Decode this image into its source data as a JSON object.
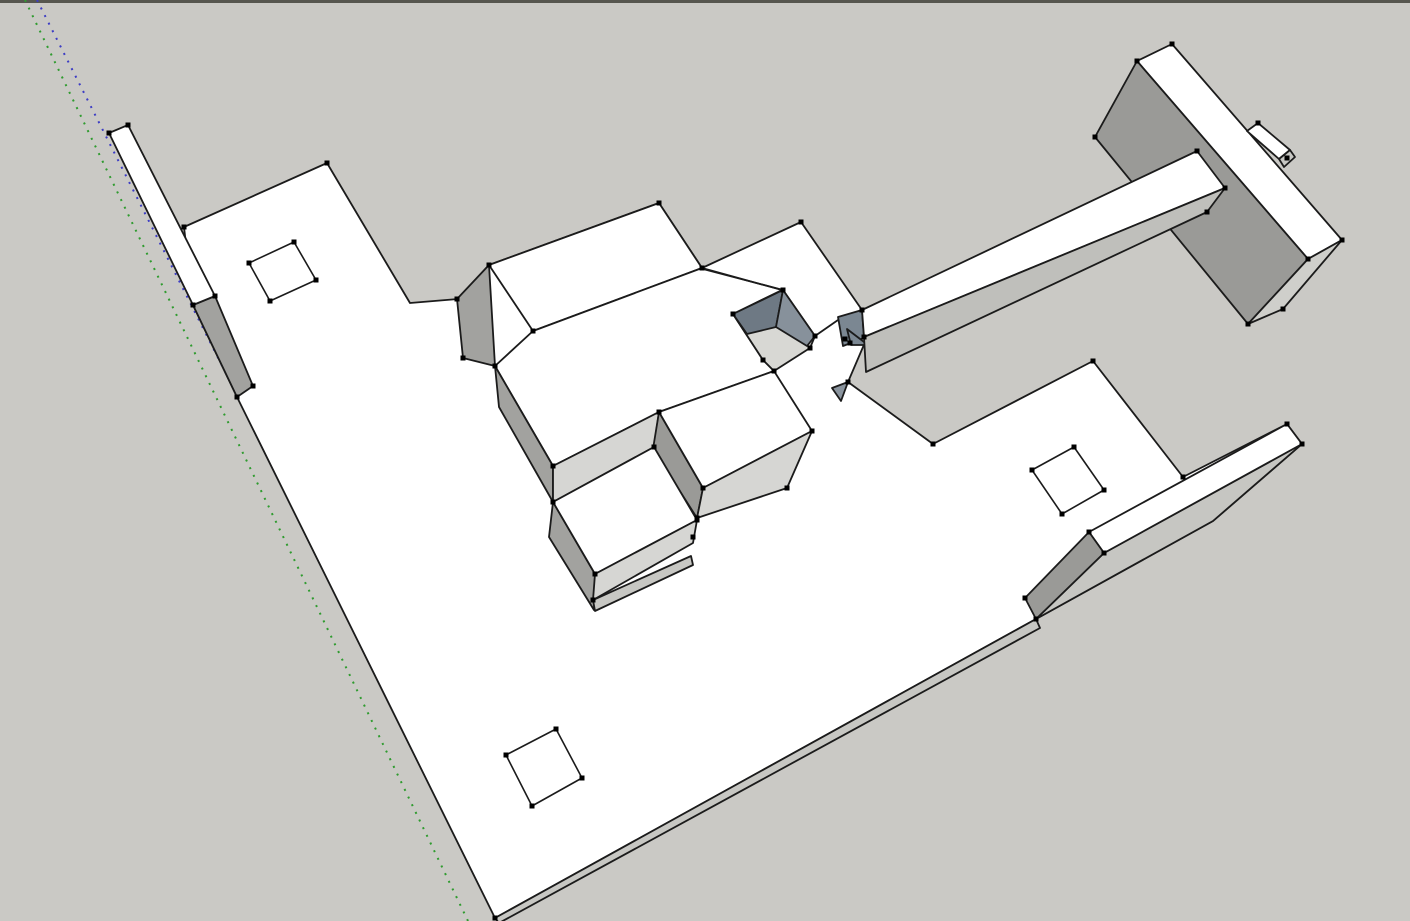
{
  "app": {
    "name": "3d-modeling-viewport",
    "description": "SketchUp-style 3D viewport showing a white architectural massing model on a gray ground with dotted negative-direction drawing axes"
  },
  "canvas": {
    "width": 1410,
    "height": 921,
    "background_color": "#cac9c5",
    "top_border_color": "#56564f",
    "top_border_height": 3
  },
  "style": {
    "edge_color": "#1b1b1b",
    "edge_width": 1.8,
    "hole_edge_width": 1.6,
    "vertex_dot_color": "#000000",
    "vertex_dot_size": 5,
    "axis_dash": "2 6.5",
    "axis_width": 2,
    "face_white": "#ffffff",
    "face_light": "#d6d6d3",
    "face_mid": "#a2a29f",
    "face_dark": "#9a9a97",
    "pit_dark": "#6e7984",
    "pit_mid": "#87919b",
    "axis_green": "#2f9b2f",
    "axis_blue": "#3c3cc4"
  },
  "axes": [
    {
      "name": "green-axis-dotted",
      "color": "#2f9b2f",
      "x1": 25,
      "y1": 0,
      "x2": 468,
      "y2": 921
    },
    {
      "name": "blue-axis-dotted",
      "color": "#3c3cc4",
      "x1": 37,
      "y1": 0,
      "x2": 503,
      "y2": 921
    }
  ],
  "faces": [
    {
      "name": "floor-plate",
      "fill": "#ffffff",
      "points": [
        [
          327,
          163
        ],
        [
          410,
          303
        ],
        [
          458,
          299
        ],
        [
          489,
          265
        ],
        [
          659,
          203
        ],
        [
          702,
          268
        ],
        [
          801,
          222
        ],
        [
          862,
          310
        ],
        [
          866,
          340
        ],
        [
          848,
          382
        ],
        [
          933,
          444
        ],
        [
          1093,
          361
        ],
        [
          1183,
          477
        ],
        [
          1287,
          424
        ],
        [
          1302,
          444
        ],
        [
          1213,
          521
        ],
        [
          1036,
          619
        ],
        [
          495,
          918
        ],
        [
          237,
          397
        ],
        [
          193,
          305
        ],
        [
          184,
          227
        ]
      ]
    },
    {
      "name": "floor-edge-strip",
      "fill": "#c7c7c3",
      "points": [
        [
          495,
          918
        ],
        [
          1036,
          619
        ],
        [
          1040,
          628
        ],
        [
          499,
          923
        ]
      ]
    },
    {
      "name": "left-wall-side",
      "fill": "#a2a29f",
      "points": [
        [
          193,
          305
        ],
        [
          215,
          296
        ],
        [
          253,
          386
        ],
        [
          237,
          397
        ]
      ]
    },
    {
      "name": "left-thin-wall",
      "fill": "#ffffff",
      "points": [
        [
          109,
          133
        ],
        [
          128,
          125
        ],
        [
          215,
          296
        ],
        [
          193,
          305
        ]
      ]
    },
    {
      "name": "box-a-roof",
      "fill": "#ffffff",
      "points": [
        [
          489,
          265
        ],
        [
          659,
          203
        ],
        [
          702,
          268
        ],
        [
          533,
          331
        ]
      ]
    },
    {
      "name": "box-a-left-wall",
      "fill": "#a2a29f",
      "points": [
        [
          489,
          265
        ],
        [
          457,
          299
        ],
        [
          463,
          358
        ],
        [
          495,
          366
        ]
      ]
    },
    {
      "name": "box-b-roof",
      "fill": "#ffffff",
      "points": [
        [
          495,
          366
        ],
        [
          533,
          331
        ],
        [
          702,
          268
        ],
        [
          782,
          290
        ],
        [
          733,
          314
        ],
        [
          763,
          360
        ],
        [
          774,
          371
        ],
        [
          659,
          412
        ],
        [
          553,
          466
        ]
      ]
    },
    {
      "name": "box-b-left-wall",
      "fill": "#a2a29f",
      "points": [
        [
          495,
          366
        ],
        [
          499,
          407
        ],
        [
          553,
          502
        ],
        [
          553,
          466
        ]
      ]
    },
    {
      "name": "box-b-front",
      "fill": "#d6d6d3",
      "points": [
        [
          553,
          466
        ],
        [
          659,
          412
        ],
        [
          654,
          447
        ],
        [
          553,
          502
        ]
      ]
    },
    {
      "name": "box-c-left-wall",
      "fill": "#9a9a97",
      "points": [
        [
          659,
          412
        ],
        [
          653,
          449
        ],
        [
          697,
          518
        ],
        [
          703,
          488
        ]
      ]
    },
    {
      "name": "box-c-roof",
      "fill": "#ffffff",
      "points": [
        [
          659,
          412
        ],
        [
          774,
          371
        ],
        [
          812,
          431
        ],
        [
          703,
          488
        ]
      ]
    },
    {
      "name": "box-c-front",
      "fill": "#d6d6d3",
      "points": [
        [
          703,
          488
        ],
        [
          812,
          431
        ],
        [
          787,
          488
        ],
        [
          697,
          518
        ]
      ]
    },
    {
      "name": "box-d-left-wall",
      "fill": "#a2a29f",
      "points": [
        [
          553,
          502
        ],
        [
          595,
          574
        ],
        [
          594,
          610
        ],
        [
          549,
          537
        ]
      ]
    },
    {
      "name": "box-d-roof",
      "fill": "#ffffff",
      "points": [
        [
          553,
          502
        ],
        [
          654,
          447
        ],
        [
          697,
          520
        ],
        [
          595,
          574
        ]
      ]
    },
    {
      "name": "box-d-front",
      "fill": "#d6d6d3",
      "points": [
        [
          595,
          574
        ],
        [
          697,
          520
        ],
        [
          693,
          543
        ],
        [
          593,
          600
        ]
      ]
    },
    {
      "name": "box-d-base-strip",
      "fill": "#c7c7c3",
      "points": [
        [
          593,
          600
        ],
        [
          691,
          556
        ],
        [
          693,
          565
        ],
        [
          595,
          611
        ]
      ]
    },
    {
      "name": "courtyard-pit-floor",
      "fill": "#d8d8d4",
      "points": [
        [
          783,
          290
        ],
        [
          815,
          336
        ],
        [
          810,
          348
        ],
        [
          774,
          371
        ],
        [
          763,
          360
        ],
        [
          733,
          314
        ]
      ]
    },
    {
      "name": "courtyard-nw-wall",
      "fill": "#6e7984",
      "points": [
        [
          733,
          314
        ],
        [
          783,
          290
        ],
        [
          776,
          327
        ],
        [
          747,
          334
        ]
      ]
    },
    {
      "name": "courtyard-ne-wall",
      "fill": "#87919b",
      "points": [
        [
          783,
          290
        ],
        [
          815,
          336
        ],
        [
          807,
          346
        ],
        [
          776,
          327
        ]
      ]
    },
    {
      "name": "courtyard-pillar",
      "fill": "#7b8792",
      "points": [
        [
          838,
          317
        ],
        [
          862,
          310
        ],
        [
          864,
          338
        ],
        [
          843,
          346
        ]
      ]
    },
    {
      "name": "courtyard-wedge-a",
      "fill": "#7b8792",
      "points": [
        [
          847,
          329
        ],
        [
          868,
          345
        ],
        [
          851,
          345
        ]
      ]
    },
    {
      "name": "courtyard-wedge-b",
      "fill": "#8a949e",
      "points": [
        [
          832,
          388
        ],
        [
          848,
          382
        ],
        [
          841,
          401
        ]
      ]
    },
    {
      "name": "big-slab-top",
      "fill": "#ffffff",
      "points": [
        [
          1172,
          44
        ],
        [
          1342,
          240
        ],
        [
          1308,
          259
        ],
        [
          1137,
          61
        ]
      ]
    },
    {
      "name": "big-slab-front",
      "fill": "#9a9a97",
      "points": [
        [
          1137,
          61
        ],
        [
          1308,
          259
        ],
        [
          1248,
          324
        ],
        [
          1095,
          137
        ]
      ]
    },
    {
      "name": "big-slab-end",
      "fill": "#cfcfcb",
      "points": [
        [
          1342,
          240
        ],
        [
          1283,
          309
        ],
        [
          1248,
          324
        ],
        [
          1308,
          259
        ]
      ]
    },
    {
      "name": "slab-notch-top",
      "fill": "#ffffff",
      "points": [
        [
          1247,
          131
        ],
        [
          1258,
          123
        ],
        [
          1290,
          150
        ],
        [
          1279,
          159
        ]
      ]
    },
    {
      "name": "slab-notch-end",
      "fill": "#c7c7c3",
      "points": [
        [
          1279,
          159
        ],
        [
          1290,
          150
        ],
        [
          1295,
          157
        ],
        [
          1284,
          167
        ]
      ]
    },
    {
      "name": "walkway-top",
      "fill": "#ffffff",
      "points": [
        [
          862,
          310
        ],
        [
          1197,
          151
        ],
        [
          1225,
          188
        ],
        [
          864,
          337
        ]
      ]
    },
    {
      "name": "walkway-underside",
      "fill": "#bfbfbb",
      "points": [
        [
          864,
          337
        ],
        [
          1225,
          188
        ],
        [
          1207,
          212
        ],
        [
          866,
          372
        ]
      ]
    },
    {
      "name": "ramp-slope",
      "fill": "#c6c6c2",
      "points": [
        [
          1104,
          553
        ],
        [
          1302,
          444
        ],
        [
          1213,
          521
        ],
        [
          1036,
          619
        ]
      ]
    },
    {
      "name": "ramp-top",
      "fill": "#ffffff",
      "points": [
        [
          1089,
          532
        ],
        [
          1287,
          424
        ],
        [
          1302,
          444
        ],
        [
          1104,
          553
        ]
      ]
    },
    {
      "name": "ramp-side-wall",
      "fill": "#9a9a97",
      "points": [
        [
          1025,
          598
        ],
        [
          1089,
          532
        ],
        [
          1104,
          553
        ],
        [
          1036,
          619
        ]
      ]
    }
  ],
  "extra_edges": [
    {
      "name": "roof-split-edge",
      "points": [
        [
          703,
          269
        ],
        [
          783,
          290
        ]
      ]
    },
    {
      "name": "roof-split-edge-2",
      "points": [
        [
          815,
          336
        ],
        [
          838,
          320
        ]
      ]
    }
  ],
  "hole_outlines": [
    {
      "name": "square-hole-left",
      "points": [
        [
          294,
          242
        ],
        [
          316,
          280
        ],
        [
          270,
          301
        ],
        [
          249,
          263
        ]
      ]
    },
    {
      "name": "square-hole-right",
      "points": [
        [
          1074,
          447
        ],
        [
          1104,
          490
        ],
        [
          1062,
          514
        ],
        [
          1032,
          470
        ]
      ]
    },
    {
      "name": "square-hole-bottom",
      "points": [
        [
          556,
          729
        ],
        [
          582,
          778
        ],
        [
          532,
          806
        ],
        [
          506,
          755
        ]
      ]
    }
  ],
  "vertex_dots": [
    [
      128,
      125
    ],
    [
      109,
      133
    ],
    [
      184,
      227
    ],
    [
      215,
      296
    ],
    [
      193,
      305
    ],
    [
      253,
      386
    ],
    [
      237,
      397
    ],
    [
      327,
      163
    ],
    [
      294,
      242
    ],
    [
      316,
      280
    ],
    [
      270,
      301
    ],
    [
      249,
      263
    ],
    [
      489,
      265
    ],
    [
      457,
      299
    ],
    [
      463,
      358
    ],
    [
      495,
      366
    ],
    [
      659,
      203
    ],
    [
      702,
      268
    ],
    [
      533,
      331
    ],
    [
      801,
      222
    ],
    [
      553,
      466
    ],
    [
      553,
      502
    ],
    [
      659,
      412
    ],
    [
      654,
      447
    ],
    [
      697,
      520
    ],
    [
      693,
      537
    ],
    [
      595,
      574
    ],
    [
      593,
      600
    ],
    [
      703,
      488
    ],
    [
      787,
      488
    ],
    [
      812,
      431
    ],
    [
      697,
      518
    ],
    [
      783,
      290
    ],
    [
      733,
      314
    ],
    [
      815,
      336
    ],
    [
      810,
      348
    ],
    [
      763,
      360
    ],
    [
      774,
      371
    ],
    [
      845,
      339
    ],
    [
      862,
      310
    ],
    [
      864,
      337
    ],
    [
      850,
      343
    ],
    [
      848,
      382
    ],
    [
      933,
      444
    ],
    [
      1093,
      361
    ],
    [
      1183,
      477
    ],
    [
      1287,
      424
    ],
    [
      1302,
      444
    ],
    [
      1089,
      532
    ],
    [
      1104,
      553
    ],
    [
      1025,
      598
    ],
    [
      1036,
      619
    ],
    [
      495,
      918
    ],
    [
      1172,
      44
    ],
    [
      1137,
      61
    ],
    [
      1095,
      137
    ],
    [
      1197,
      151
    ],
    [
      1225,
      188
    ],
    [
      1207,
      212
    ],
    [
      1248,
      324
    ],
    [
      1283,
      309
    ],
    [
      1308,
      259
    ],
    [
      1342,
      240
    ],
    [
      1258,
      123
    ],
    [
      1287,
      158
    ],
    [
      1074,
      447
    ],
    [
      1104,
      490
    ],
    [
      1062,
      514
    ],
    [
      1032,
      470
    ],
    [
      556,
      729
    ],
    [
      582,
      778
    ],
    [
      532,
      806
    ],
    [
      506,
      755
    ]
  ]
}
